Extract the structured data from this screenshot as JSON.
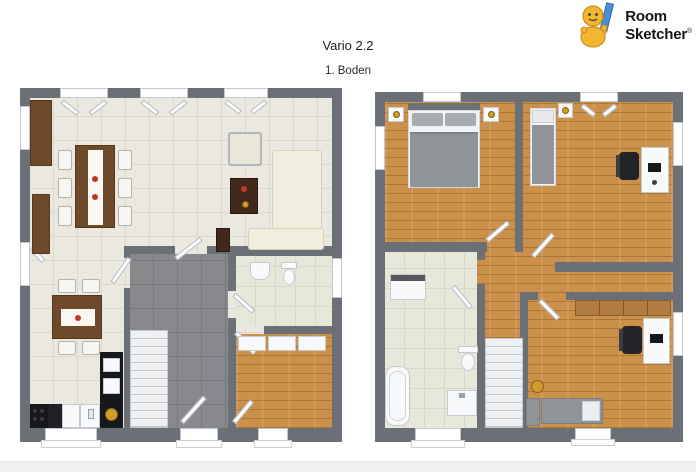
{
  "header": {
    "title": "Vario 2.2",
    "subtitle": "1. Boden"
  },
  "logo": {
    "word1": "Room",
    "word2": "Sketcher",
    "registered_mark": "®"
  },
  "colors": {
    "wall": "#6b7077",
    "tile_floor": "#ebe8df",
    "dark_tile_floor": "#87898d",
    "bath_tile_floor": "#e7e8da",
    "wood_floor": "#cb9049",
    "furniture_wood": "#6f4a2a",
    "bed_gray": "#8f9499",
    "accent_gold": "#cf9d2e",
    "footer_strip": "#f1f1f2",
    "logo_yellow": "#f2b72e",
    "logo_pencil_blue": "#4a8fd3"
  }
}
